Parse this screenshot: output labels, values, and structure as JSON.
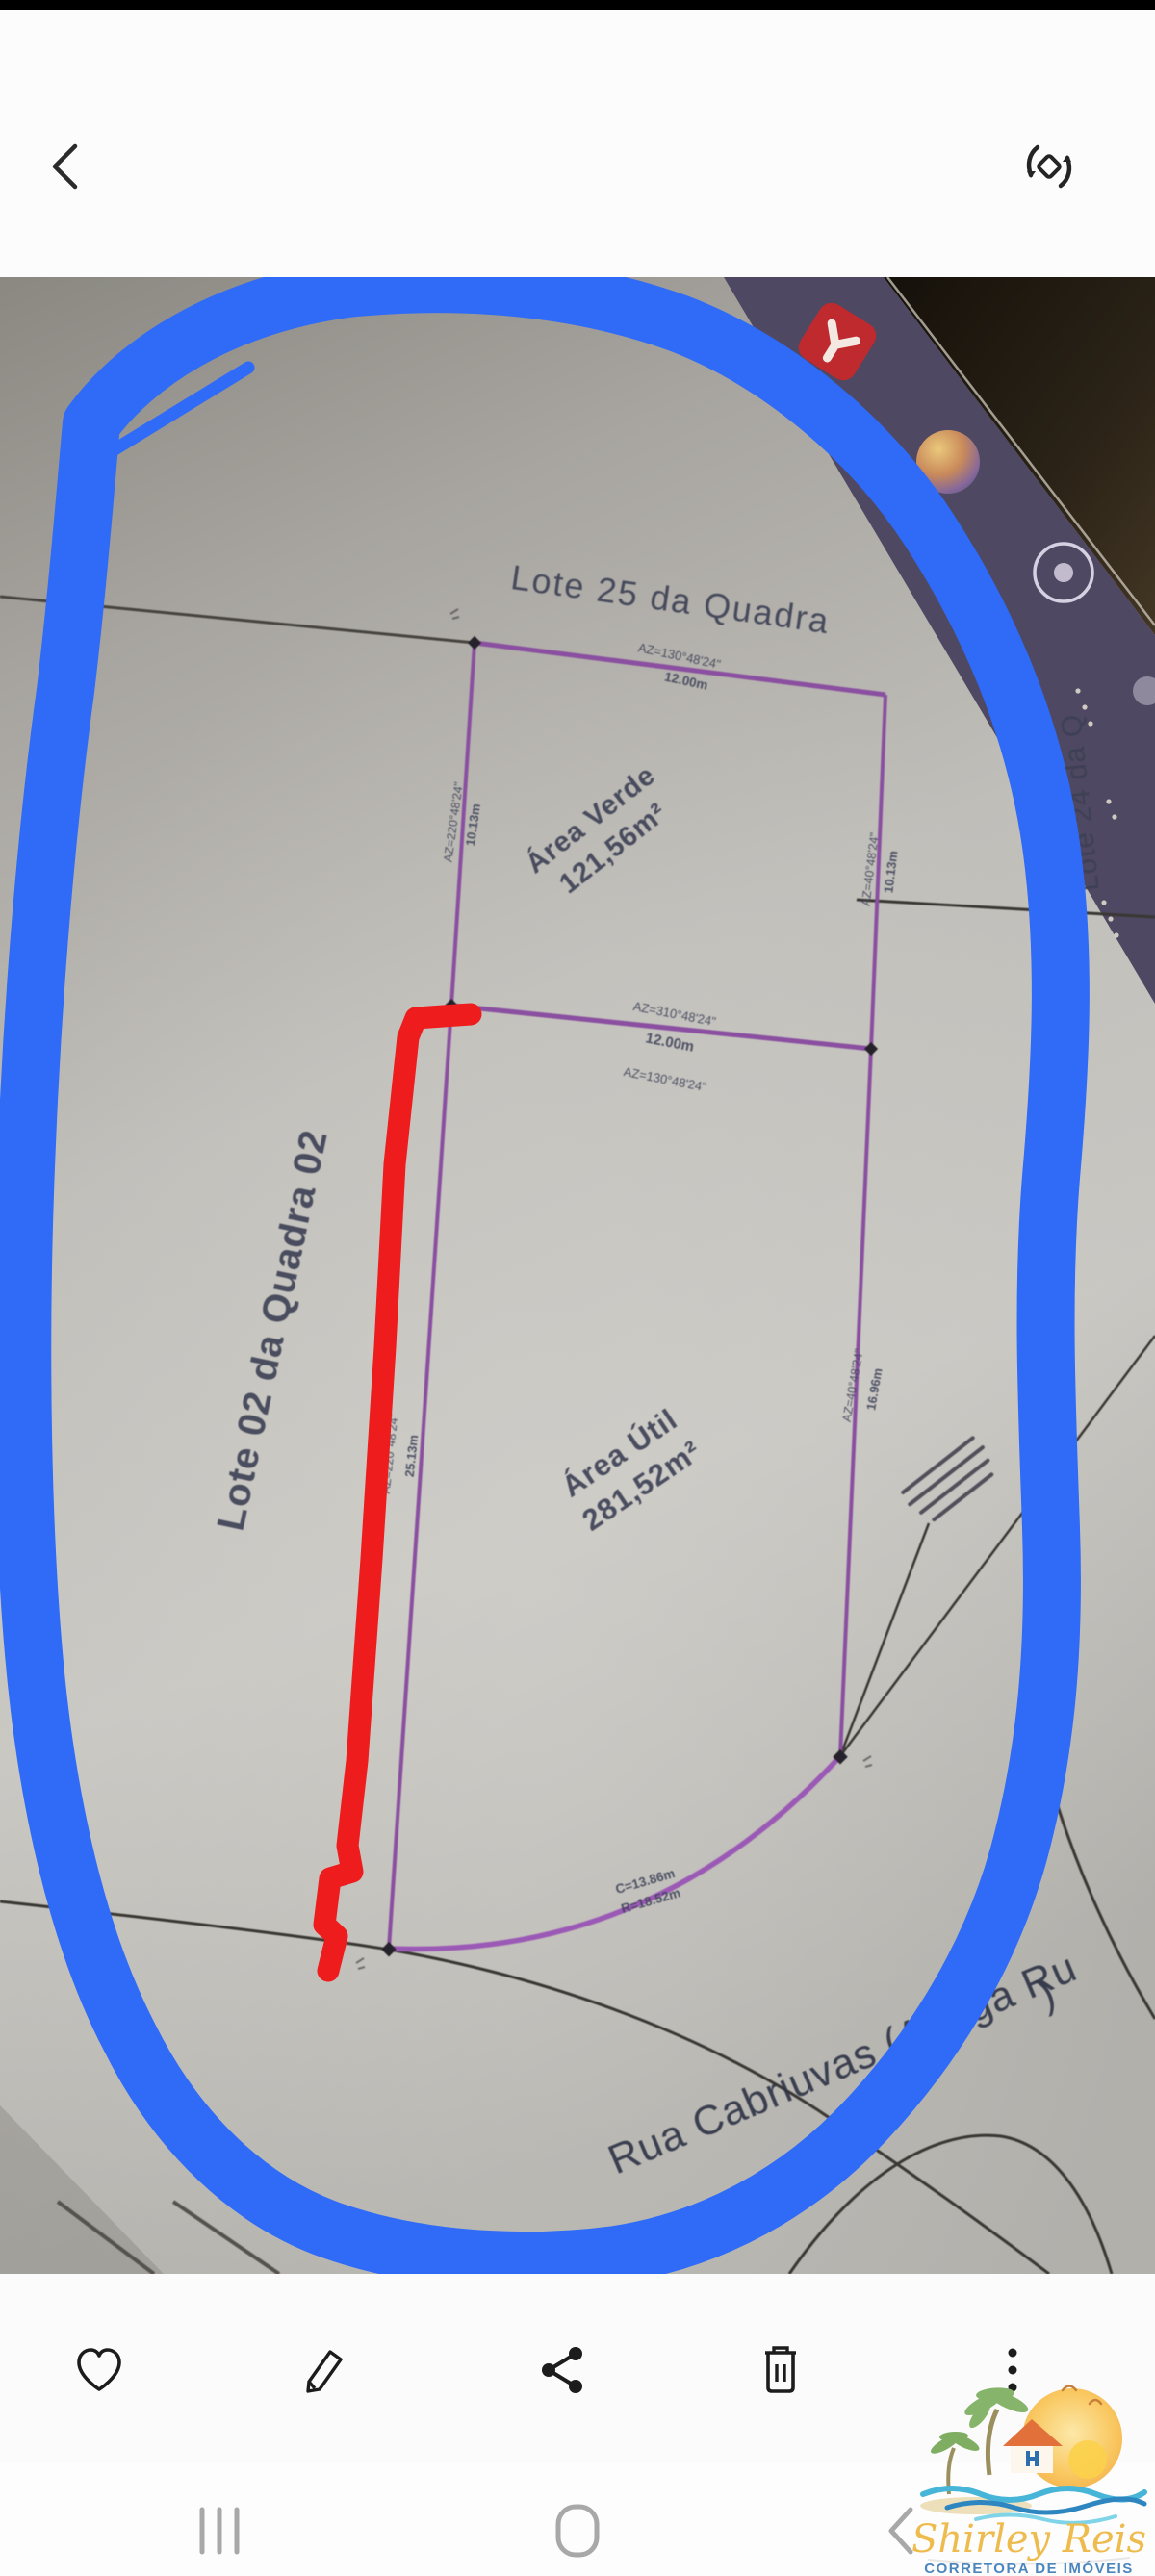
{
  "header": {
    "back_icon": "back-chevron",
    "rotate_icon": "rotate-screen"
  },
  "photo": {
    "screen_apps": {
      "app1": "red-app-icon",
      "app2": "photos-sphere-icon",
      "app3": "camera-lens-icon"
    },
    "plan": {
      "lot25": "Lote 25 da Quadra",
      "lot02": "Lote 02 da Quadra 02",
      "lot24": "Lote 24 da Q",
      "area_verde_title": "Área Verde",
      "area_verde_value": "121,56m²",
      "area_util_title": "Área Útil",
      "area_util_value": "281,52m²",
      "street": "Rua Cabriuvas (Antiga Ru",
      "street_paren": ")",
      "m": {
        "top_az": "AZ=130°48'24\"",
        "top_len": "12.00m",
        "mid_az1": "AZ=310°48'24\"",
        "mid_len": "12.00m",
        "mid_az2": "AZ=130°48'24\"",
        "left_up_az": "AZ=220°48'24\"",
        "left_up_len": "10.13m",
        "left_low_az": "AZ=220°48'24\"",
        "left_low_len": "25.13m",
        "right_up_az": "AZ=40°48'24\"",
        "right_up_len": "10.13m",
        "right_low_az": "AZ=40°48'24\"",
        "right_low_len": "16.96m",
        "curve_c": "C=13.86m",
        "curve_r": "R=18.52m"
      }
    },
    "annotations": {
      "oval_color": "#2f6bf7",
      "line_color": "#ee1c1c"
    }
  },
  "toolbar": {
    "icons": [
      "favorite-heart",
      "edit-pencil",
      "share",
      "delete-trash",
      "more-vert"
    ]
  },
  "watermark": {
    "brand": "Shirley Reis",
    "subtitle": "CORRETORA DE IMÓVEIS",
    "creci": "CRECI 287.155-F"
  },
  "navbar": {
    "icons": [
      "recents",
      "home",
      "back"
    ]
  }
}
